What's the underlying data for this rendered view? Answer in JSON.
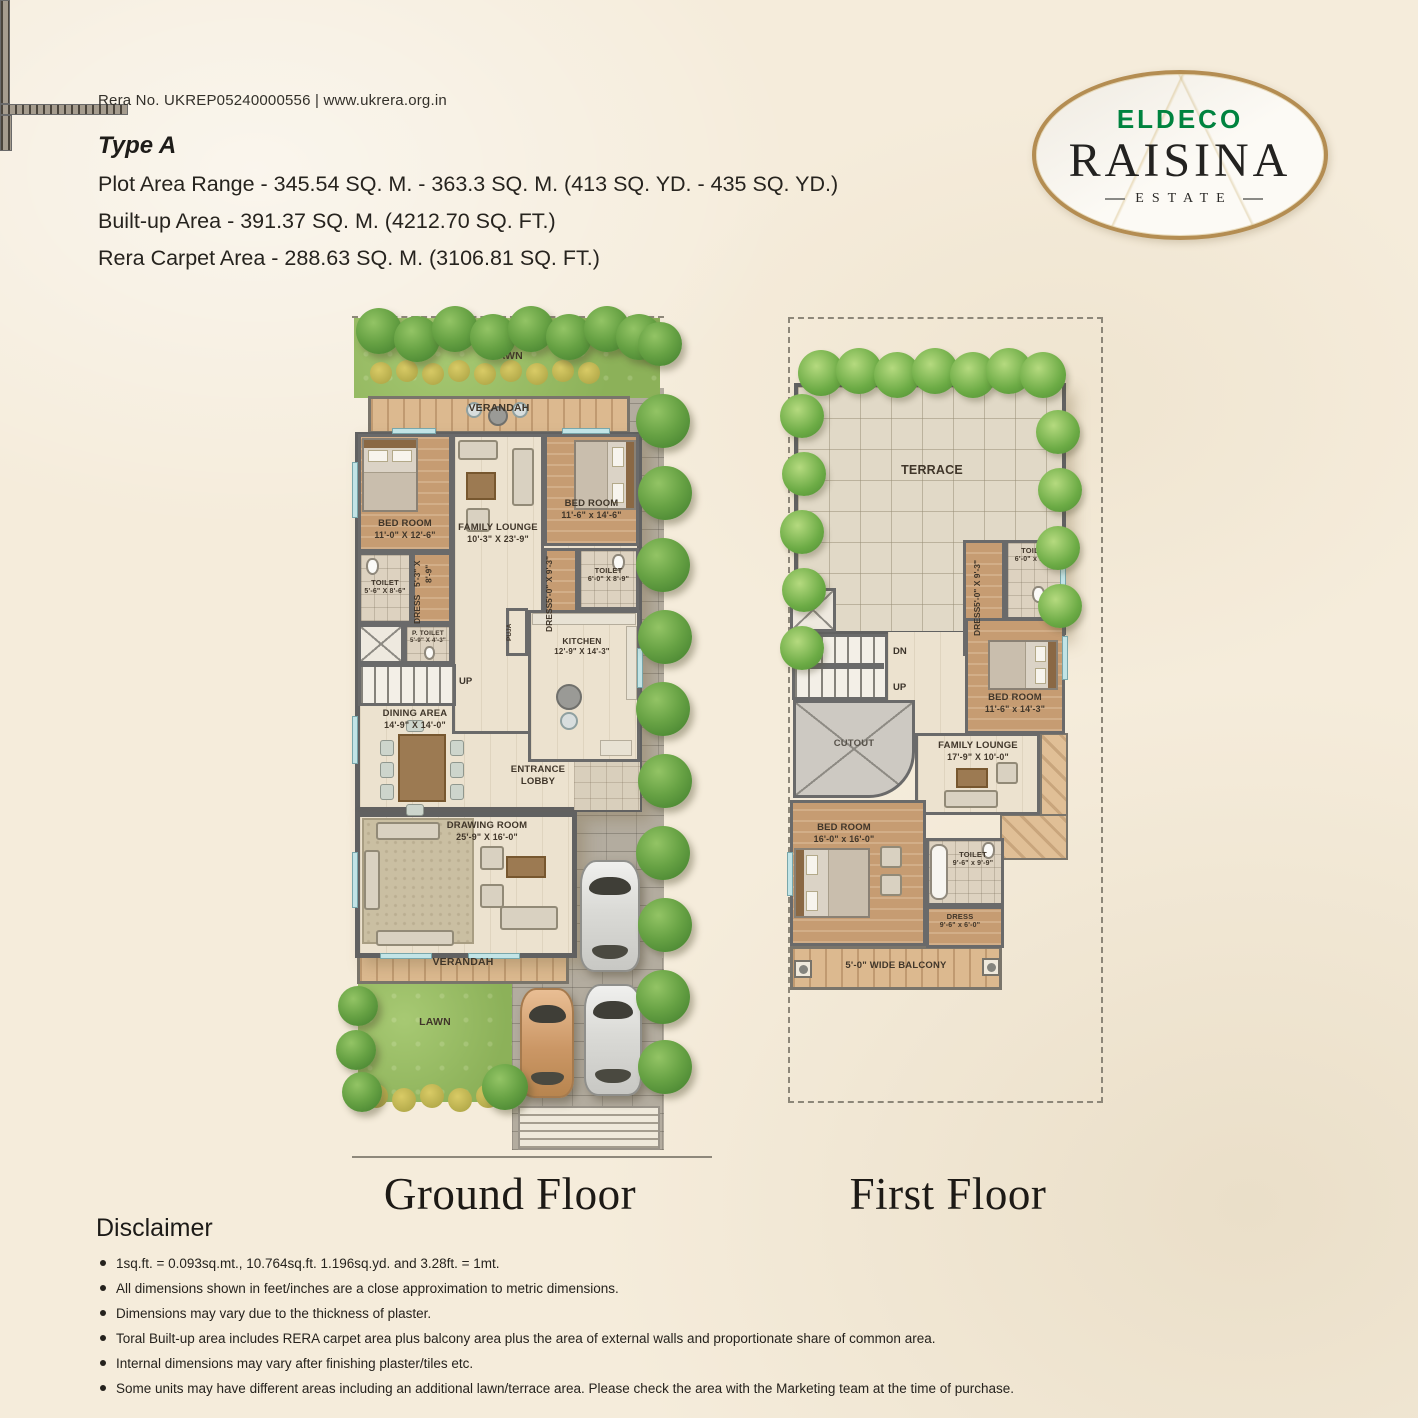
{
  "colors": {
    "brand_green": "#00833F",
    "logo_ring_gold": "#B48D52",
    "paper_cream": "#F5ECDB",
    "lawn_green": "#93B75F",
    "wall_gray": "#676767"
  },
  "header": {
    "rera_line": "Rera No. UKREP05240000556 | www.ukrera.org.in",
    "type_label": "Type A",
    "plot_area_line": "Plot Area Range - 345.54 SQ. M. - 363.3 SQ. M. (413 SQ. YD. - 435 SQ. YD.)",
    "built_up_line": "Built-up Area - 391.37 SQ. M. (4212.70 SQ. FT.)",
    "carpet_line": "Rera Carpet Area - 288.63 SQ. M. (3106.81 SQ. FT.)"
  },
  "logo": {
    "brand": "ELDECO",
    "name": "RAISINA",
    "subtitle": "ESTATE"
  },
  "ground_floor": {
    "title": "Ground Floor",
    "lawn_top": "LAWN",
    "verandah_top": "VERANDAH",
    "bedroom1_name": "BED ROOM",
    "bedroom1_dims": "11'-0\" X 12'-6\"",
    "family_lounge_name": "FAMILY LOUNGE",
    "family_lounge_dims": "10'-3\" X 23'-9\"",
    "bedroom2_name": "BED ROOM",
    "bedroom2_dims": "11'-6\" x 14'-6\"",
    "toilet1_name": "TOILET",
    "toilet1_dims": "5'-6\" X 8'-6\"",
    "dress1_name": "DRESS",
    "dress1_dims": "5'-3\" X 8'-9\"",
    "ptoilet_name": "P. TOILET",
    "ptoilet_dims": "5'-9\" X 4'-3\"",
    "dress2_name": "DRESS",
    "dress2_dims": "5'-0\" X 9'-3\"",
    "toilet2_name": "TOILET",
    "toilet2_dims": "6'-0\" X 8'-9\"",
    "puja": "PUJA",
    "kitchen_name": "KITCHEN",
    "kitchen_dims": "12'-9\" X 14'-3\"",
    "up_label": "UP",
    "dining_name": "DINING AREA",
    "dining_dims": "14'-9\" X 14'-0\"",
    "lobby_name": "ENTRANCE LOBBY",
    "drawing_name": "DRAWING ROOM",
    "drawing_dims": "25'-9\" X 16'-0\"",
    "verandah_bottom": "VERANDAH",
    "lawn_bottom": "LAWN"
  },
  "first_floor": {
    "title": "First Floor",
    "terrace": "TERRACE",
    "toilet_top_name": "TOILET",
    "toilet_top_dims": "6'-0\" x 9'-3\"",
    "dress_top_name": "DRESS",
    "dress_top_dims": "5'-0\" X 9'-3\"",
    "dn_label": "DN",
    "up_label": "UP",
    "bedroom1_name": "BED ROOM",
    "bedroom1_dims": "11'-6\" x 14'-3\"",
    "cutout": "CUTOUT",
    "family_lounge_name": "FAMILY LOUNGE",
    "family_lounge_dims": "17'-9\" X 10'-0\"",
    "bedroom2_name": "BED ROOM",
    "bedroom2_dims": "16'-0\" x 16'-0\"",
    "toilet_bottom_name": "TOILET",
    "toilet_bottom_dims": "9'-6\" x 9'-9\"",
    "dress_bottom_name": "DRESS",
    "dress_bottom_dims": "9'-6\" x 6'-0\"",
    "balcony": "5'-0\" WIDE BALCONY"
  },
  "disclaimer": {
    "title": "Disclaimer",
    "bullets": [
      "1sq.ft. = 0.093sq.mt., 10.764sq.ft. 1.196sq.yd. and 3.28ft. = 1mt.",
      "All dimensions shown in feet/inches are a close approximation to metric dimensions.",
      "Dimensions may vary due to the thickness of plaster.",
      "Toral Built-up area includes RERA carpet area plus balcony area plus the area of external walls and proportionate share of common area.",
      "Internal dimensions may vary after finishing plaster/tiles etc.",
      "Some units may have different areas including an additional lawn/terrace area. Please check the area with the Marketing team at the time of purchase."
    ]
  }
}
